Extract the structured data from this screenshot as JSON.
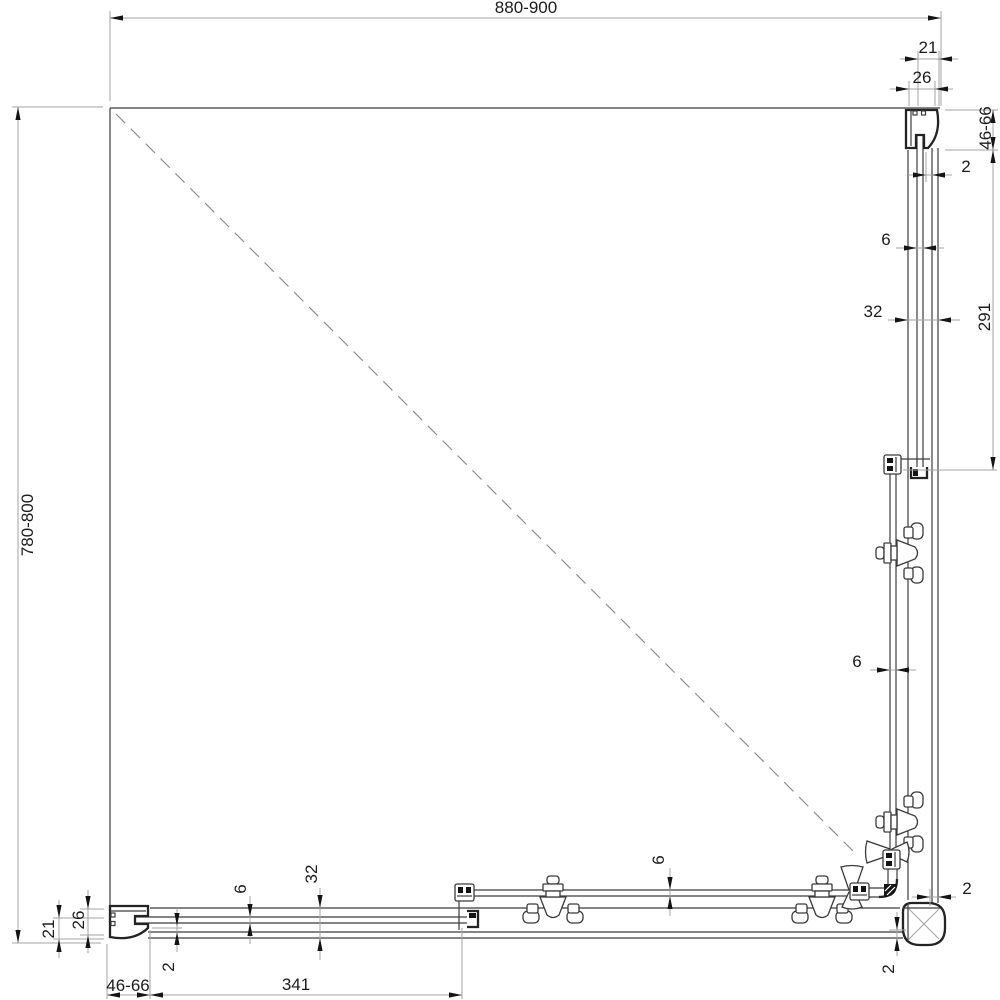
{
  "dims": {
    "width_top": "880-900",
    "depth_left": "780-800",
    "top_profile_21": "21",
    "top_profile_26": "26",
    "right_adjust": "46-66",
    "right_gap_top": "2",
    "right_glass_fixed": "6",
    "right_profile_32": "32",
    "right_fixed_length": "291",
    "right_glass_door": "6",
    "corner_gap_right": "2",
    "corner_gap_bottom": "2",
    "bottom_glass_door": "6",
    "bottom_profile_32": "32",
    "bottom_glass_fixed": "6",
    "bottom_gap_left": "2",
    "left_profile_21": "21",
    "left_profile_26": "26",
    "bottom_adjust": "46-66",
    "bottom_fixed_length": "341"
  },
  "colors": {
    "background": "#ffffff",
    "drawing_line": "#3c3c3c",
    "profile_line": "#232323",
    "dimension_line": "#a3a3a3",
    "text": "#1c1c1c"
  }
}
